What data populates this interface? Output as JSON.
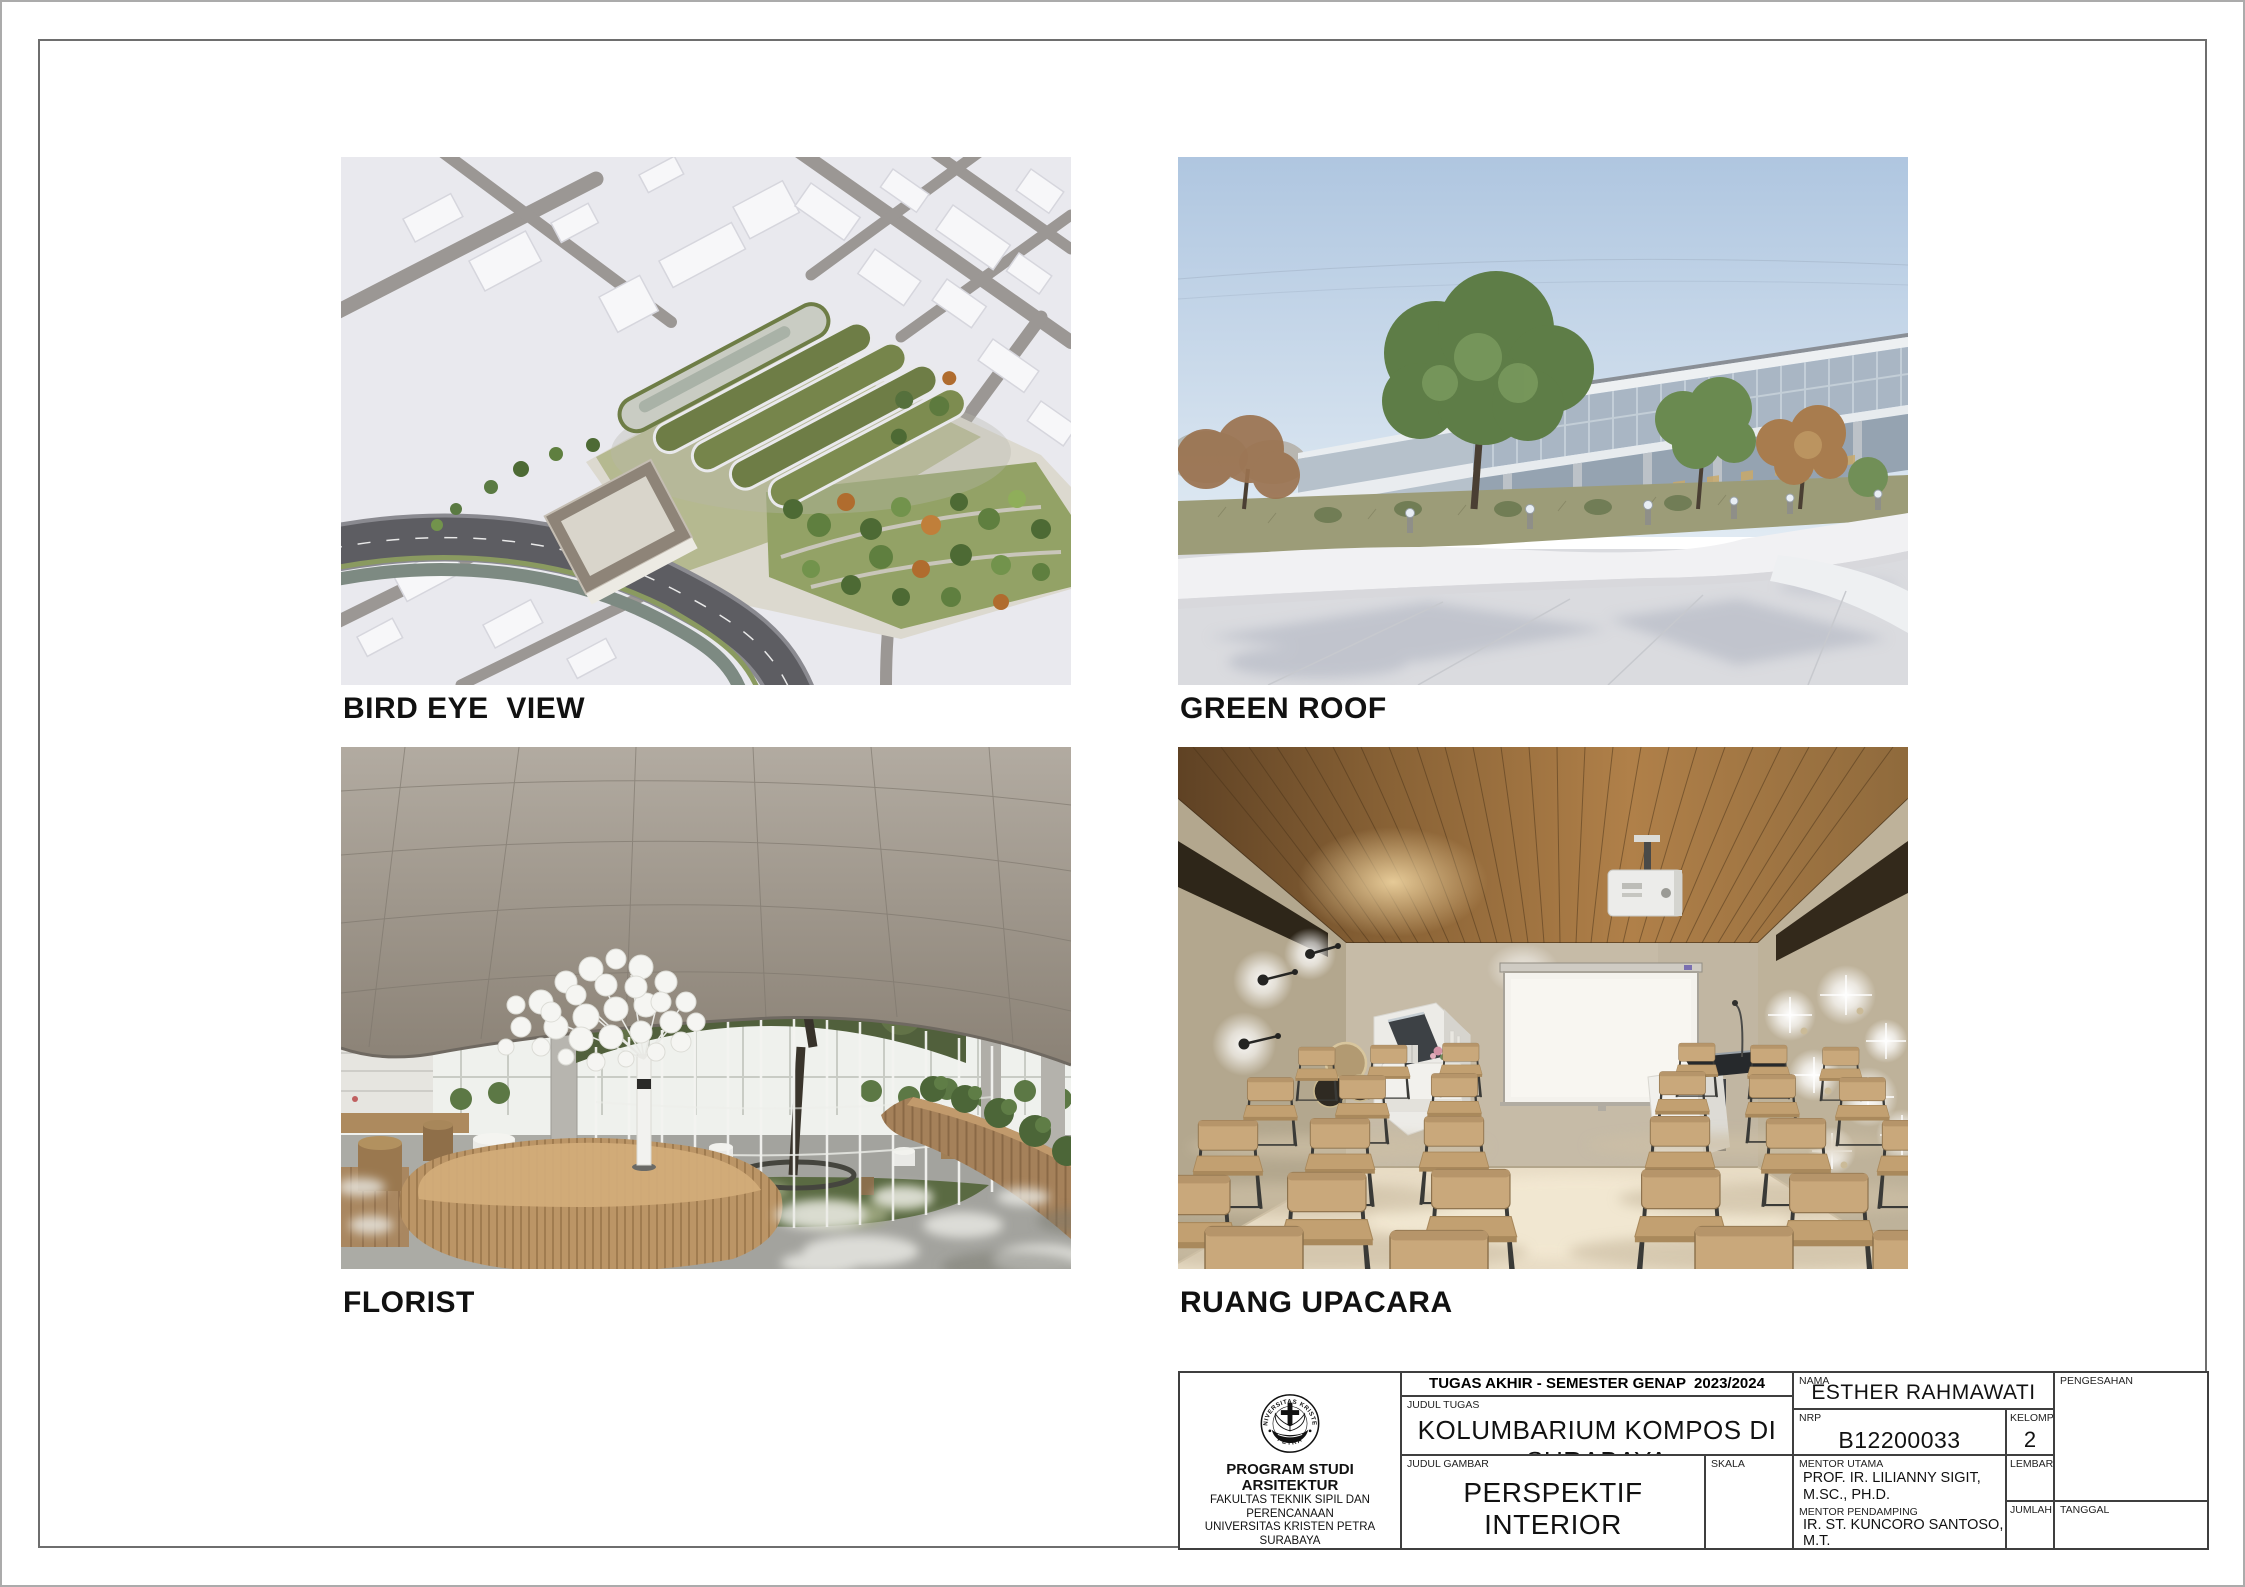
{
  "page": {
    "sheet_background": "#ffffff",
    "frame_color": "#6e6e6e",
    "titleblock_line_color": "#3f3f3f"
  },
  "figures": [
    {
      "id": "bird-eye-view",
      "caption": "BIRD EYE  VIEW",
      "description": "Aerial render of kolumbarium complex with terraced wavy green roofs, white city massing blocks and a curved main road",
      "palette": {
        "background": "#e9e9ee",
        "streets": "#9b9794",
        "asphalt": "#5d5d62",
        "green_roof": "#6e7d46",
        "trees_green": "#4d6a34",
        "trees_autumn": "#b06c2e"
      }
    },
    {
      "id": "green-roof",
      "caption": "GREEN ROOF",
      "description": "Exterior view of roof garden with green and autumn trees, bollard lights, white curved planter wall and glass facade",
      "palette": {
        "sky_top": "#afc6e0",
        "sky_bottom": "#e0eaf3",
        "glass": "#a9b6c4",
        "planter_wall": "#f1f1f3",
        "pavement": "#dadbdf",
        "grass": "#9c9c78"
      }
    },
    {
      "id": "florist",
      "caption": "FLORIST",
      "description": "Interior florist hall with circular glass courtyard around a tree, perforated curved ceiling, wooden counters and white disc sculpture tree",
      "palette": {
        "ceiling": "#a49c92",
        "floor": "#a3a39e",
        "wood_counter": "#bb9566",
        "planter_wood": "#a5815a",
        "courtyard_grass": "#5a6a42",
        "sculpture": "#f5f5f2"
      }
    },
    {
      "id": "ruang-upacara",
      "caption": "RUANG UPACARA",
      "description": "Ceremony room with timber slat ceiling, projector and screen, wall lamps, casket niche, lectern and rows of wooden chairs",
      "palette": {
        "ceiling_wood": "#8a6336",
        "walls": "#c6bba7",
        "floor": "#e8dcc5",
        "chair_wood": "#c9a87b",
        "screen": "#f4f2ed"
      }
    }
  ],
  "title_block": {
    "header": "TUGAS AKHIR - SEMESTER GENAP  2023/2024",
    "judul_tugas": {
      "label": "JUDUL TUGAS",
      "value": "KOLUMBARIUM KOMPOS DI SURABAYA"
    },
    "judul_gambar": {
      "label": "JUDUL GAMBAR",
      "value": "PERSPEKTIF INTERIOR"
    },
    "skala": {
      "label": "SKALA",
      "value": ""
    },
    "nama": {
      "label": "NAMA",
      "value": "ESTHER RAHMAWATI"
    },
    "nrp": {
      "label": "NRP",
      "value": "B12200033"
    },
    "kelompok": {
      "label": "KELOMPOK",
      "value": "2"
    },
    "mentor_utama": {
      "label": "MENTOR UTAMA",
      "value": "PROF. IR. LILIANNY SIGIT, M.SC., PH.D."
    },
    "mentor_pendamping": {
      "label": "MENTOR PENDAMPING",
      "values": [
        "IR. ST. KUNCORO SANTOSO, M.T.",
        "ANIK JUNIWATI, S.T., M.T.",
        "ESTI ASIH NURDIAH, S.T., M.T., PH.D."
      ]
    },
    "lembar": {
      "label": "LEMBAR",
      "value": ""
    },
    "jumlah": {
      "label": "JUMLAH",
      "value": ""
    },
    "pengesahan": {
      "label": "PENGESAHAN",
      "value": ""
    },
    "tanggal": {
      "label": "TANGGAL",
      "value": ""
    },
    "institution": {
      "seal_top": "UNIVERSITAS KRISTEN",
      "seal_bottom": "PETRA",
      "program": "PROGRAM STUDI ARSITEKTUR",
      "lines": [
        "FAKULTAS TEKNIK SIPIL DAN PERENCANAAN",
        "UNIVERSITAS KRISTEN PETRA",
        "SURABAYA"
      ]
    }
  }
}
